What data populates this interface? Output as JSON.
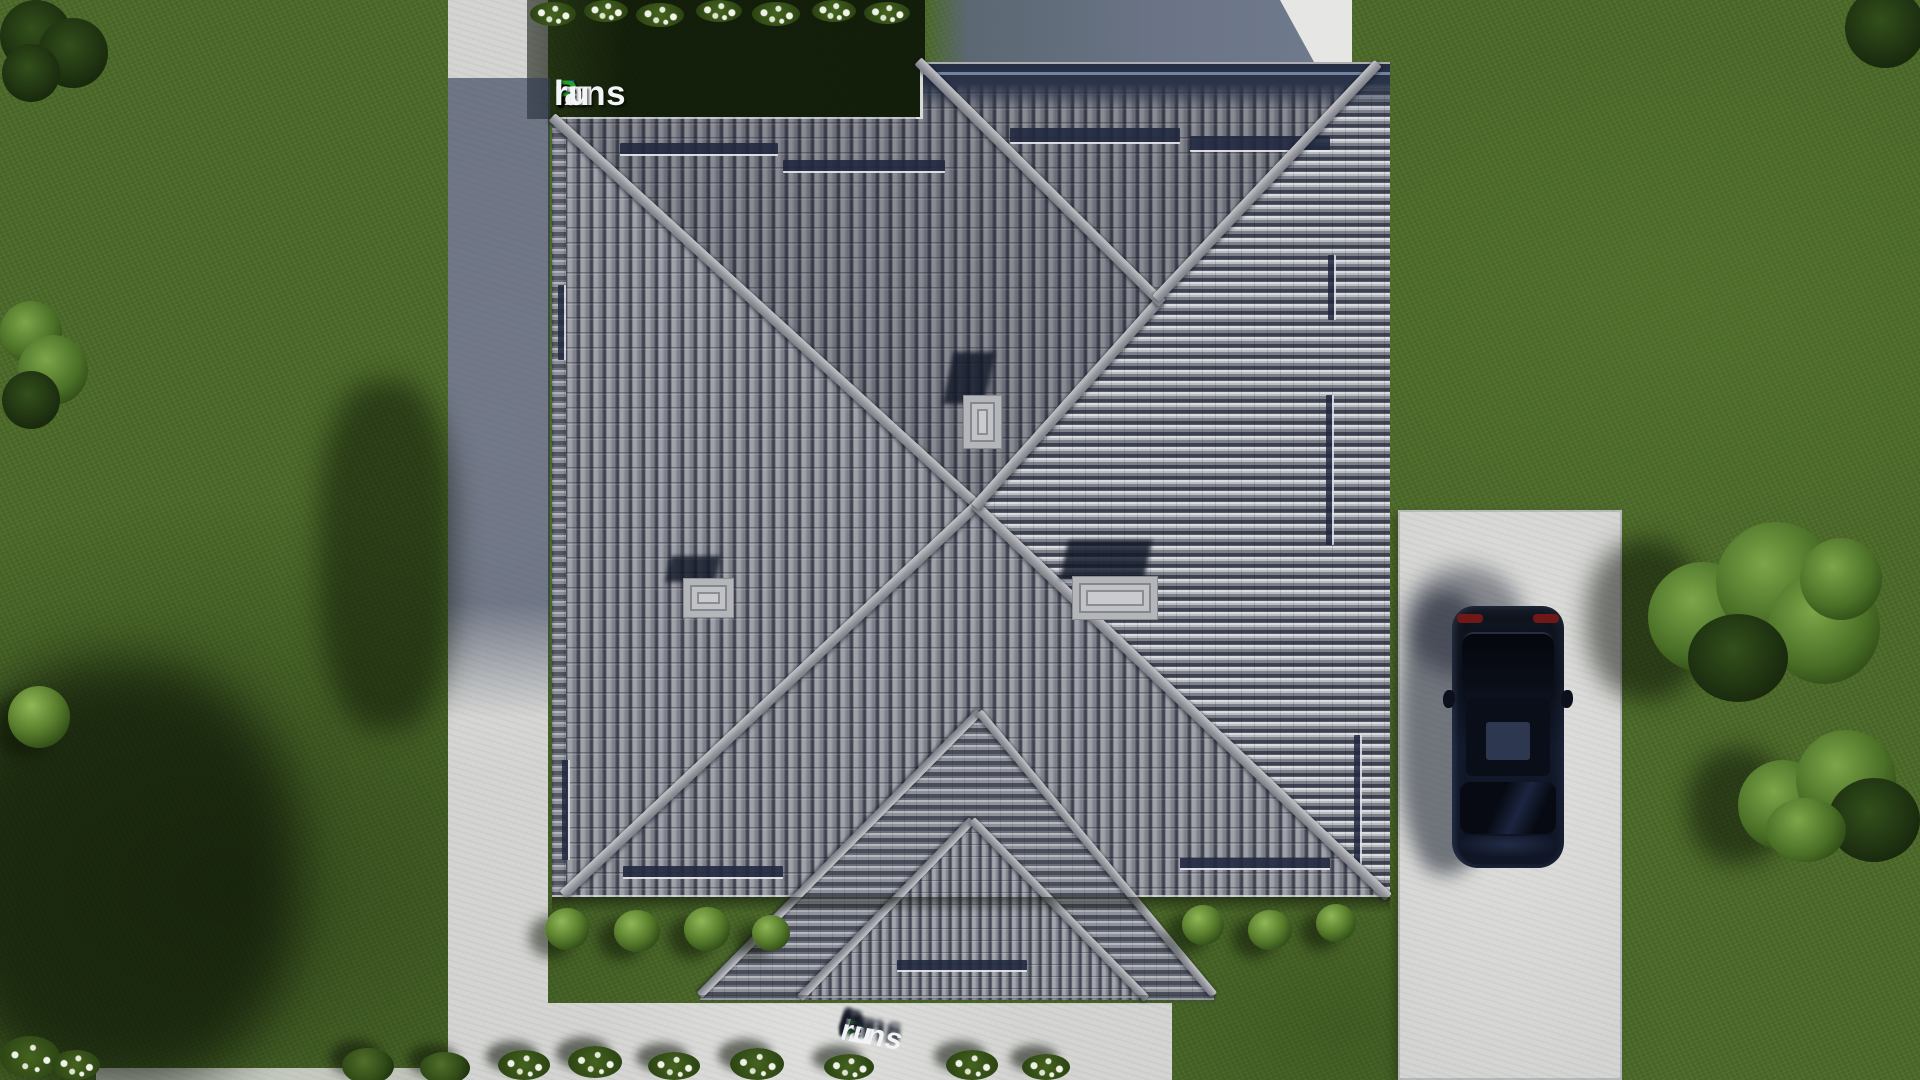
{
  "brand": {
    "text": "FixPlans.ru",
    "segments": [
      {
        "text": "F",
        "color": "#2257e6"
      },
      {
        "text": "ix",
        "color": "#f4f5f7"
      },
      {
        "text": "P",
        "color": "#27a228"
      },
      {
        "text": "lans",
        "color": "#f4f5f7"
      },
      {
        "text": ".",
        "color": "#2257e6"
      },
      {
        "text": "ru",
        "color": "#f4f5f7"
      }
    ]
  },
  "scene": {
    "view": "top-down aerial render of a house plot",
    "roof_tile_color": "#8b8d96",
    "ridge_color": "#a8aaae",
    "lawn_color": "#4c6a29",
    "paving_color": "#d4d5d2",
    "car_color": "#0d1322",
    "chimney_count": 3
  }
}
